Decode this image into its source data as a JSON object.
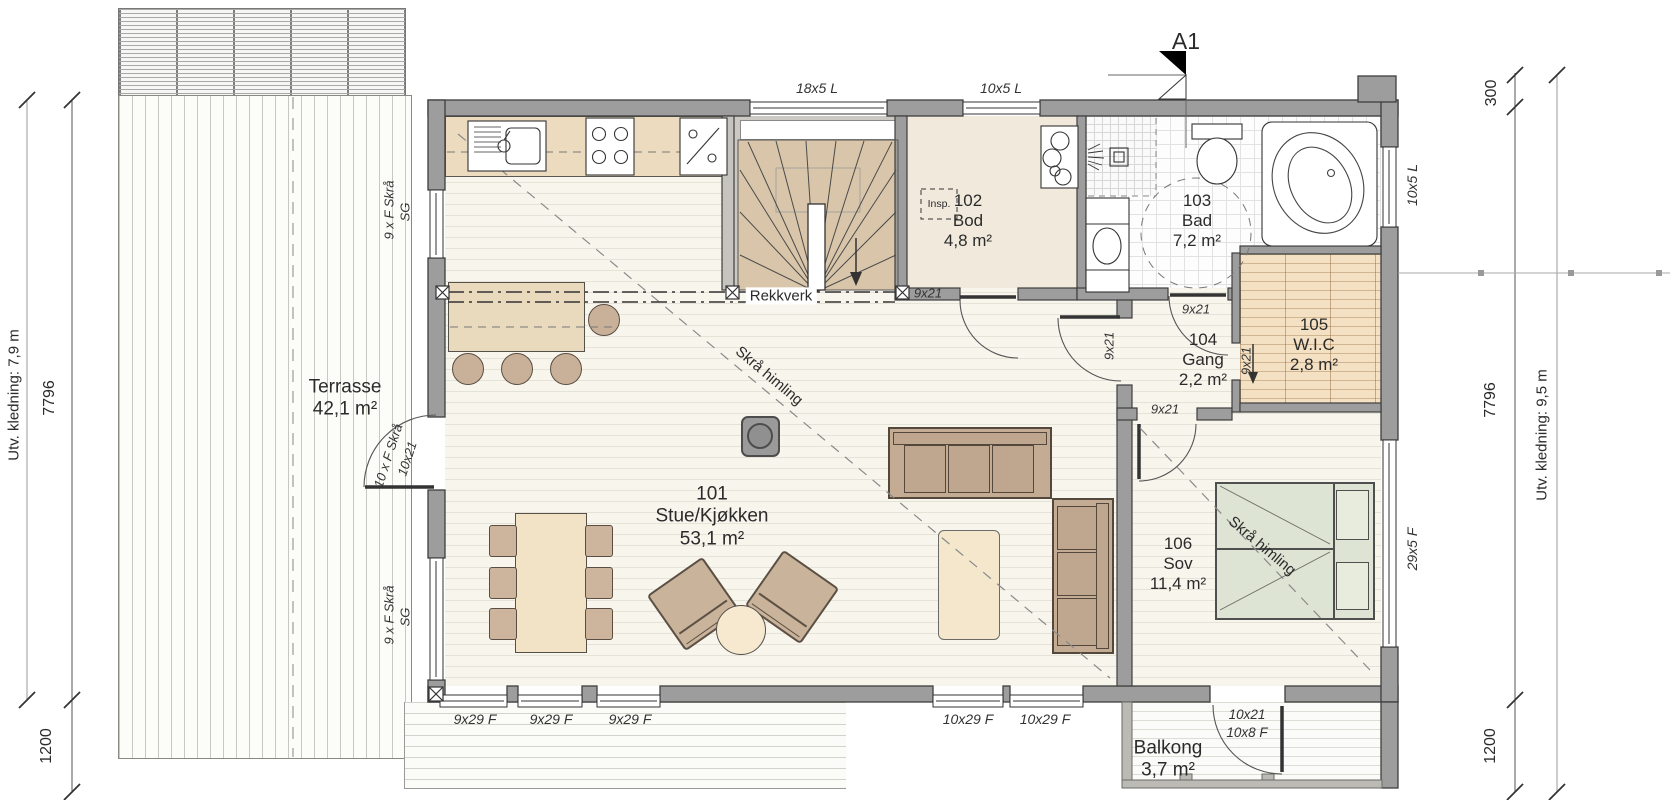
{
  "marker": {
    "a1": "A1"
  },
  "rooms": {
    "terrasse": {
      "name": "Terrasse",
      "area": "42,1 m²"
    },
    "stue": {
      "number": "101",
      "name": "Stue/Kjøkken",
      "area": "53,1 m²"
    },
    "bod": {
      "number": "102",
      "name": "Bod",
      "area": "4,8 m²"
    },
    "bad": {
      "number": "103",
      "name": "Bad",
      "area": "7,2 m²"
    },
    "gang": {
      "number": "104",
      "name": "Gang",
      "area": "2,2 m²"
    },
    "wic": {
      "number": "105",
      "name": "W.I.C",
      "area": "2,8 m²"
    },
    "sov": {
      "number": "106",
      "name": "Sov",
      "area": "11,4 m²"
    },
    "balkong": {
      "name": "Balkong",
      "area": "3,7 m²"
    }
  },
  "windows": {
    "top_living": "18x5 L",
    "top_bod": "10x5 L",
    "right_bad": "10x5 L",
    "right_sov": "29x5 F",
    "bottom_1": "9x29 F",
    "bottom_2": "9x29 F",
    "bottom_3": "9x29 F",
    "bottom_4": "10x29 F",
    "bottom_5": "10x29 F"
  },
  "doors": {
    "bod": "9x21",
    "bad": "9x21",
    "gang_living": "9x21",
    "gang_wic": "9x21",
    "gang_sov": "9x21",
    "terrace_type": "10 x F Skrå",
    "terrace_size": "10x21",
    "balcony_size": "10x21",
    "balcony_side": "10x8 F"
  },
  "facade_labels": {
    "left_upper_type": "9 x F Skrå",
    "left_upper_glass": "SG",
    "left_lower_type": "9 x F Skrå",
    "left_lower_glass": "SG"
  },
  "annotations": {
    "railing": "Rekkverk",
    "sloped_ceiling_living": "Skrå himling",
    "sloped_ceiling_sov": "Skrå himling",
    "inspection": "Insp."
  },
  "dimensions": {
    "left_cladding": "Utv. kledning: 7,9 m",
    "left_length": "7796",
    "left_offset": "1200",
    "right_overhang": "300",
    "right_length": "7796",
    "right_cladding": "Utv. kledning: 9,5 m",
    "right_offset": "1200"
  },
  "colors": {
    "wall": "#9d9d9d",
    "wood": "#e9d7bb",
    "stair": "#d9c6aa",
    "bed": "#dee4d4",
    "floor": "#f8f5ed",
    "wic": "#f4e0c2"
  }
}
